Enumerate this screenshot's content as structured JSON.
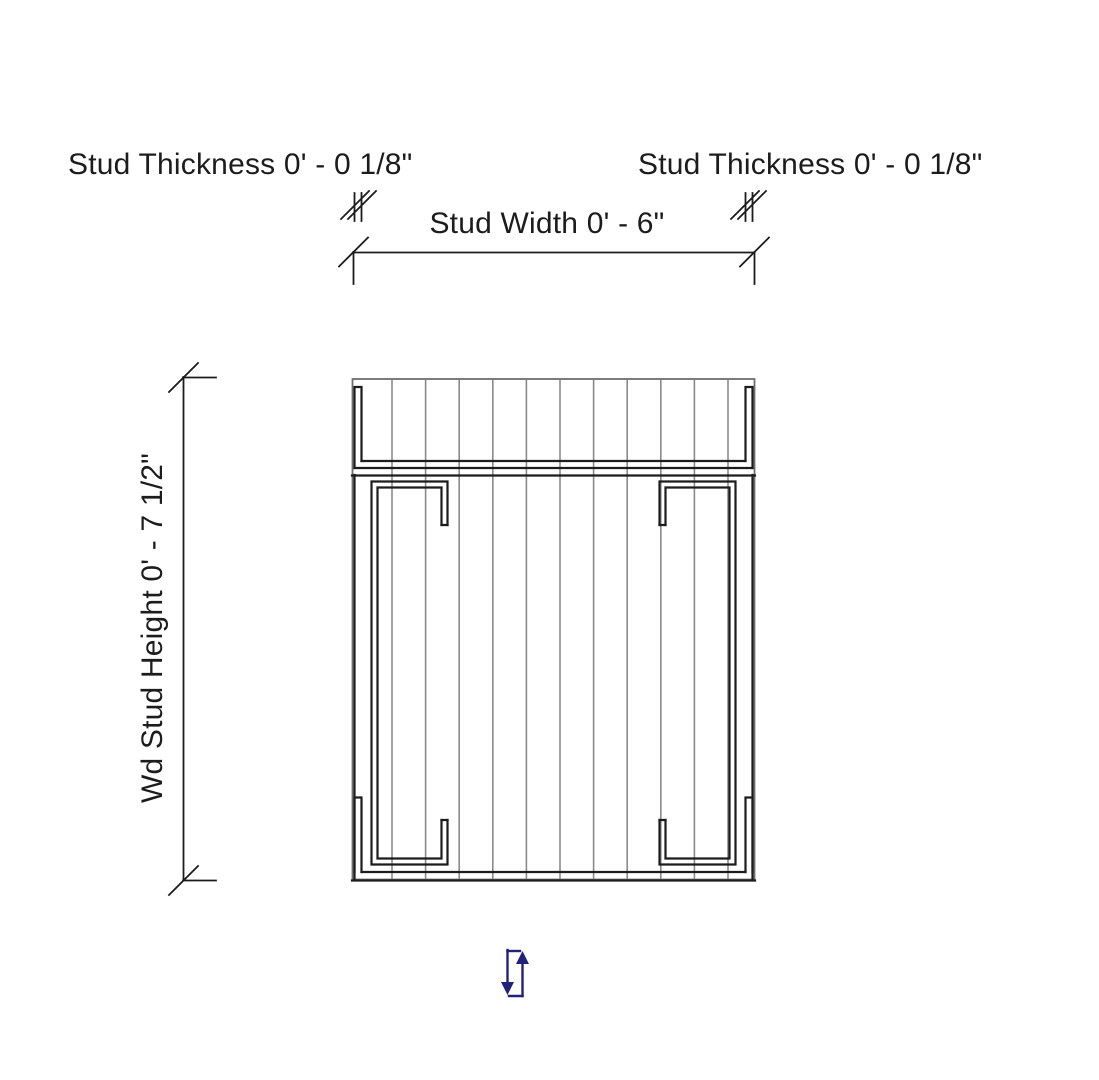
{
  "page": {
    "width": 1099,
    "height": 1080,
    "view": "stud-profile-section-preview"
  },
  "colors": {
    "background": "#ffffff",
    "line": "#1c1c1c",
    "hatch": "#8a8a8a",
    "boundary": "#6e6e6e",
    "flip_control": "#22227a"
  },
  "annotations": {
    "stud_thickness_left": {
      "parameter": "Stud Thickness",
      "value": "0' - 0 1/8\"",
      "text": "Stud Thickness 0' - 0 1/8\""
    },
    "stud_thickness_right": {
      "parameter": "Stud Thickness",
      "value": "0' - 0 1/8\"",
      "text": "Stud Thickness 0' - 0 1/8\""
    },
    "stud_width": {
      "parameter": "Stud Width",
      "value": "0' - 6\"",
      "text": "Stud Width 0' - 6\""
    },
    "wd_stud_height": {
      "parameter": "Wd Stud Height",
      "value": "0' - 7 1/2\"",
      "text": "Wd Stud Height 0' - 7 1/2\""
    }
  },
  "icons": {
    "flip_control": "flip-up-down-arrows-icon"
  }
}
